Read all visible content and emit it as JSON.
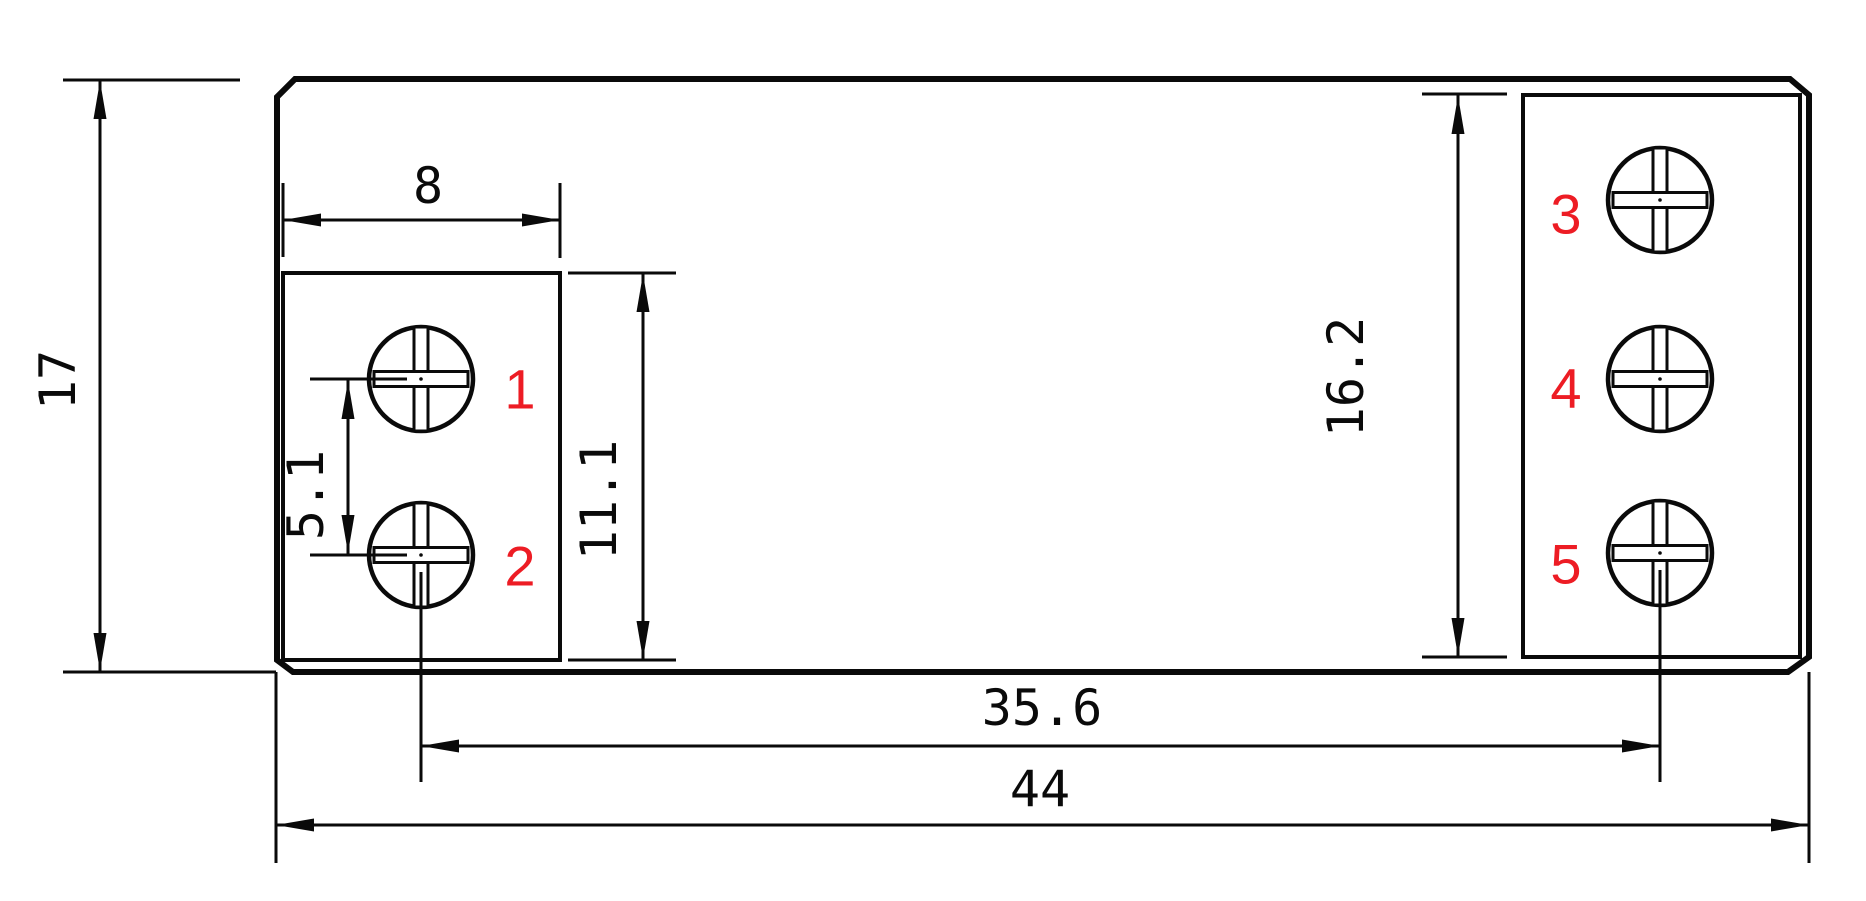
{
  "drawing": {
    "type": "engineering-dimension-drawing",
    "subject": "relay footprint with five screw terminals",
    "colors": {
      "background": "#ffffff",
      "line": "#0a0a0a",
      "terminal_label": "#ed1c24"
    },
    "dims": {
      "overall_height": "17",
      "left_block_width": "8",
      "left_screw_pitch": "5.1",
      "left_block_height": "11.1",
      "right_block_height": "16.2",
      "screw_center_span": "35.6",
      "overall_width": "44"
    },
    "terminals": [
      "1",
      "2",
      "3",
      "4",
      "5"
    ]
  }
}
